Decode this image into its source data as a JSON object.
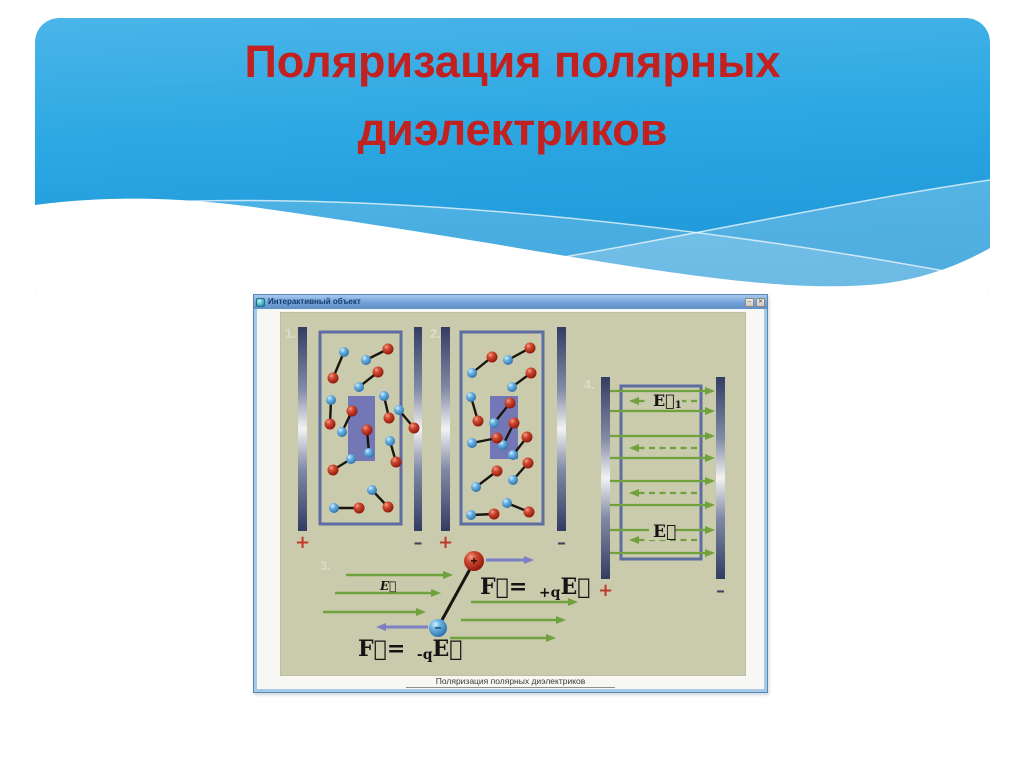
{
  "slide": {
    "title_line1": "Поляризация полярных",
    "title_line2": "диэлектриков",
    "colors": {
      "title": "#c32020",
      "sky_top": "#4ab5e9",
      "sky_mid": "#2ba7e2",
      "sky_bottom": "#1d95d6",
      "wave": "#ffffff"
    }
  },
  "window": {
    "title": "Интерактивный объект",
    "caption": "Поляризация полярных диэлектриков",
    "buttons": [
      {
        "name": "minimize",
        "glyph": "–"
      },
      {
        "name": "close",
        "glyph": "✕"
      }
    ]
  },
  "diagram": {
    "bg": "#cacaac",
    "colors": {
      "green": "#6fa23c",
      "violet": "#7b7fc4",
      "box_border": "#5c6da1",
      "highlight": "#7377b6",
      "plus": "#c0392b",
      "minus": "#3c4660",
      "label": "#dbdcc9",
      "formula": "#141414",
      "rod": "#1b150f"
    },
    "panel_labels": [
      {
        "text": "1.",
        "x": 285,
        "y": 338
      },
      {
        "text": "2.",
        "x": 430,
        "y": 338
      },
      {
        "text": "3.",
        "x": 320,
        "y": 570
      },
      {
        "text": "4.",
        "x": 584,
        "y": 389
      }
    ],
    "electrodes": [
      {
        "x": 298,
        "y": 327,
        "w": 9,
        "h": 204,
        "sign": "+"
      },
      {
        "x": 414,
        "y": 327,
        "w": 8,
        "h": 204,
        "sign": "–"
      },
      {
        "x": 441,
        "y": 327,
        "w": 9,
        "h": 204,
        "sign": "+"
      },
      {
        "x": 557,
        "y": 327,
        "w": 9,
        "h": 204,
        "sign": "–"
      },
      {
        "x": 601,
        "y": 377,
        "w": 9,
        "h": 202,
        "sign": "+"
      },
      {
        "x": 716,
        "y": 377,
        "w": 9,
        "h": 202,
        "sign": "–"
      }
    ],
    "boxes": [
      {
        "x": 320,
        "y": 332,
        "w": 81,
        "h": 192
      },
      {
        "x": 461,
        "y": 332,
        "w": 82,
        "h": 192
      },
      {
        "x": 621,
        "y": 386,
        "w": 80,
        "h": 173
      }
    ],
    "highlights": [
      {
        "x": 348,
        "y": 396,
        "w": 27,
        "h": 65
      },
      {
        "x": 490,
        "y": 396,
        "w": 28,
        "h": 63
      }
    ],
    "dipoles_panel1": [
      {
        "b": [
          344,
          352
        ],
        "r": [
          333,
          378
        ]
      },
      {
        "b": [
          366,
          360
        ],
        "r": [
          388,
          349
        ]
      },
      {
        "b": [
          359,
          387
        ],
        "r": [
          378,
          372
        ]
      },
      {
        "b": [
          331,
          400
        ],
        "r": [
          330,
          424
        ]
      },
      {
        "b": [
          384,
          396
        ],
        "r": [
          389,
          418
        ]
      },
      {
        "b": [
          342,
          432
        ],
        "r": [
          352,
          411
        ]
      },
      {
        "b": [
          369,
          453
        ],
        "r": [
          367,
          430
        ]
      },
      {
        "b": [
          399,
          410
        ],
        "r": [
          414,
          428
        ]
      },
      {
        "b": [
          351,
          459
        ],
        "r": [
          333,
          470
        ]
      },
      {
        "b": [
          390,
          441
        ],
        "r": [
          396,
          462
        ]
      },
      {
        "b": [
          372,
          490
        ],
        "r": [
          388,
          507
        ]
      },
      {
        "b": [
          334,
          508
        ],
        "r": [
          359,
          508
        ]
      }
    ],
    "dipoles_panel2": [
      {
        "r": [
          492,
          357
        ],
        "b": [
          472,
          373
        ]
      },
      {
        "r": [
          530,
          348
        ],
        "b": [
          508,
          360
        ]
      },
      {
        "r": [
          531,
          373
        ],
        "b": [
          512,
          387
        ]
      },
      {
        "b": [
          471,
          397
        ],
        "r": [
          478,
          421
        ]
      },
      {
        "r": [
          510,
          403
        ],
        "b": [
          494,
          423
        ]
      },
      {
        "r": [
          514,
          423
        ],
        "b": [
          503,
          445
        ]
      },
      {
        "b": [
          472,
          443
        ],
        "r": [
          497,
          438
        ]
      },
      {
        "r": [
          527,
          437
        ],
        "b": [
          513,
          455
        ]
      },
      {
        "r": [
          497,
          471
        ],
        "b": [
          476,
          487
        ]
      },
      {
        "r": [
          528,
          463
        ],
        "b": [
          513,
          480
        ]
      },
      {
        "b": [
          471,
          515
        ],
        "r": [
          494,
          514
        ]
      },
      {
        "b": [
          507,
          503
        ],
        "r": [
          529,
          512
        ]
      }
    ],
    "field_rows": {
      "x_solid": [
        610,
        715
      ],
      "x_dashed": [
        697,
        629
      ],
      "groups_y": [
        [
          391,
          401,
          411
        ],
        [
          436,
          448,
          458
        ],
        [
          481,
          493,
          505
        ],
        [
          530,
          540,
          553
        ]
      ]
    },
    "labels": {
      "E1": {
        "x": 653,
        "y": 406
      },
      "E4": {
        "x": 653,
        "y": 537
      },
      "E3": {
        "x": 380,
        "y": 590
      }
    },
    "panel3": {
      "left_arrows": [
        [
          346,
          453,
          575
        ],
        [
          335,
          441,
          593
        ],
        [
          323,
          426,
          612
        ]
      ],
      "right_arrows": [
        [
          471,
          578,
          602
        ],
        [
          461,
          566,
          620
        ],
        [
          450,
          556,
          638
        ]
      ],
      "rod": [
        470,
        569,
        442,
        620
      ],
      "red_charge": {
        "x": 474,
        "y": 561,
        "r": 10,
        "sign": "+"
      },
      "blue_charge": {
        "x": 438,
        "y": 628,
        "r": 9,
        "sign": "–"
      },
      "force_right": [
        486,
        560,
        534
      ],
      "force_left": [
        428,
        627,
        376
      ],
      "formula_pos": {
        "x": 480,
        "y": 594
      },
      "formula_neg": {
        "x": 358,
        "y": 656
      }
    },
    "formulas": {
      "f_eq": "F⃗= ",
      "plus_q": "+q",
      "minus_q": "-q",
      "e_vec": "E⃗",
      "e1_sub": "1"
    }
  }
}
